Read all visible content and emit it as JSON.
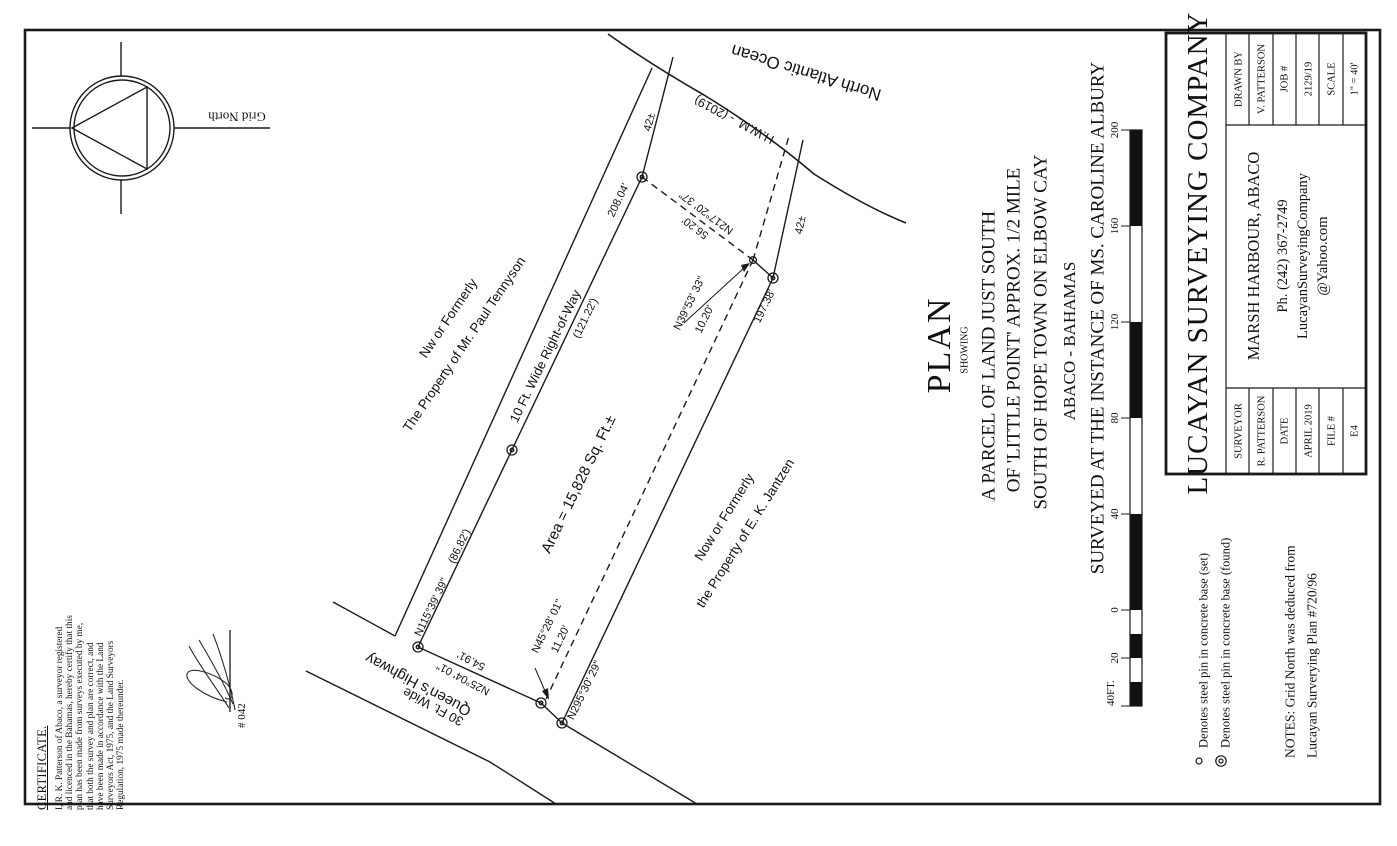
{
  "compass": {
    "label": "Grid North"
  },
  "certificate": {
    "heading": "CERTIFICATE.",
    "lines": [
      "I, R. K. Patterson of Abaco, a surveyor registered",
      "and licenced in the Bahamas, hereby certify that this",
      "plan has been made from surveys executed by me,",
      "that both the survey and plan are correct, and",
      "have been made in accordance with the Land",
      "Surveyors Act, 1975, and the Land Surveyors",
      "Regulation, 1975 made thereunder."
    ],
    "license": "# 042"
  },
  "labels": {
    "nw_bearing": "N115°39' 39\"",
    "nw_seg1": "(86.82')",
    "nw_seg2": "(121.22')",
    "nw_total": "208.04'",
    "right_of_way": "10 Ft. Wide Right-of-Way",
    "area": "Area = 15,828 Sq. Ft.±",
    "ne_tie_bearing": "N217°20' 37\"",
    "ne_tie_dist": "56.20'",
    "ne_leg_bearing": "N39°53' 33\"",
    "ne_leg_dist": "10.20'",
    "tie_a": "42±",
    "tie_b": "42±",
    "se_dist": "197.38'",
    "se_bearing": "N295°30' 29\"",
    "sw_leg_bearing": "N45°28' 01\"",
    "sw_leg_dist": "11.20'",
    "hw_dist": "54.91'",
    "hw_bearing": "N25°04' 01\""
  },
  "features": {
    "ocean": "North Atlantic Ocean",
    "hwm": "H.W.M. - (2019)",
    "highway_name": "Queen's Highway",
    "highway_width": "30 Ft. Wide"
  },
  "adjoiners": {
    "north1": "Nw or Formerly",
    "north2": "The Property of Mr. Paul Tennyson",
    "south1": "Now or Formerly",
    "south2": "the Property of E. K. Jantzen"
  },
  "title": {
    "plan": "PLAN",
    "showing": "SHOWING",
    "line1": "A PARCEL OF LAND JUST SOUTH",
    "line2": "OF 'LITTLE POINT' APPROX. 1/2 MILE",
    "line3": "SOUTH OF HOPE TOWN ON ELBOW CAY",
    "line4": "ABACO - BAHAMAS",
    "line5": "SURVEYED AT THE INSTANCE OF MS. CAROLINE ALBURY"
  },
  "scale_bar": {
    "t200": "200",
    "t160": "160",
    "t120": "120",
    "t80": "80",
    "t40": "40",
    "t0": "0",
    "t20": "20",
    "unit": "40FT."
  },
  "title_block": {
    "company": "LUCAYAN SURVEYING COMPANY",
    "address": "MARSH HARBOUR, ABACO",
    "phone": "Ph. (242) 367-2749",
    "email1": "LucayanSurveyingCompany",
    "email2": "@Yahoo.com",
    "surveyor_label": "SURVEYOR",
    "surveyor": "R. PATTERSON",
    "date_label": "DATE",
    "date": "APRIL 2019",
    "file_label": "FILE #",
    "file": "E4",
    "drawn_by_label": "DRAWN BY",
    "drawn_by": "V. PATTERSON",
    "job_label": "JOB #",
    "job": "2129/19",
    "scale_label": "SCALE",
    "scale": "1\" = 40'"
  },
  "legend": {
    "set": "Denotes steel pin in concrete base (set)",
    "found": "Denotes steel pin in concrete base (found)"
  },
  "notes": {
    "line1": "NOTES: Grid North was deduced from",
    "line2": "Lucayan Surverying Plan #720/96"
  }
}
